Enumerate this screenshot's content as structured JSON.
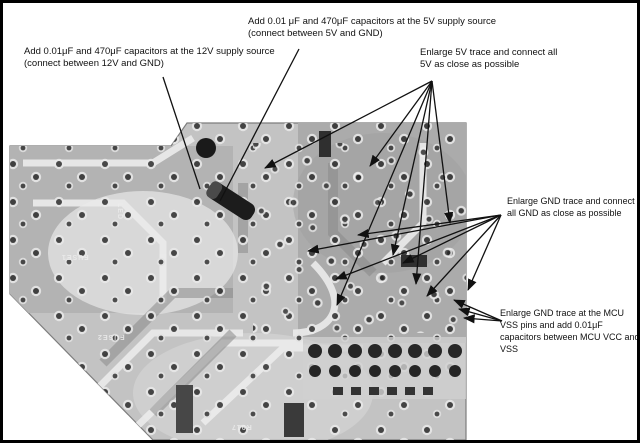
{
  "figure": {
    "kind": "annotated-pcb-rework-diagram"
  },
  "annotations": {
    "add_caps_5v": "Add 0.01 μF and 470μF capacitors at the 5V supply source (connect between 5V and GND)",
    "add_caps_12v": "Add 0.01μF and 470μF capacitors at the 12V supply source (connect between 12V and GND)",
    "enlarge_5v_trace": "Enlarge 5V trace and connect all 5V as close as possible",
    "enlarge_gnd_trace": "Enlarge GND trace and connect all GND as close as possible",
    "enlarge_gnd_mcu": "Enlarge GND trace at the MCU VSS pins and add 0.01μF capacitors between MCU VCC and VSS"
  },
  "board": {
    "silkscreen_labels": [
      "FUSE1",
      "FUSE2",
      "LED",
      "R917"
    ]
  },
  "colors": {
    "arrow": "#111111",
    "board_base": "#c3c3c3",
    "frame_border": "#000000"
  }
}
